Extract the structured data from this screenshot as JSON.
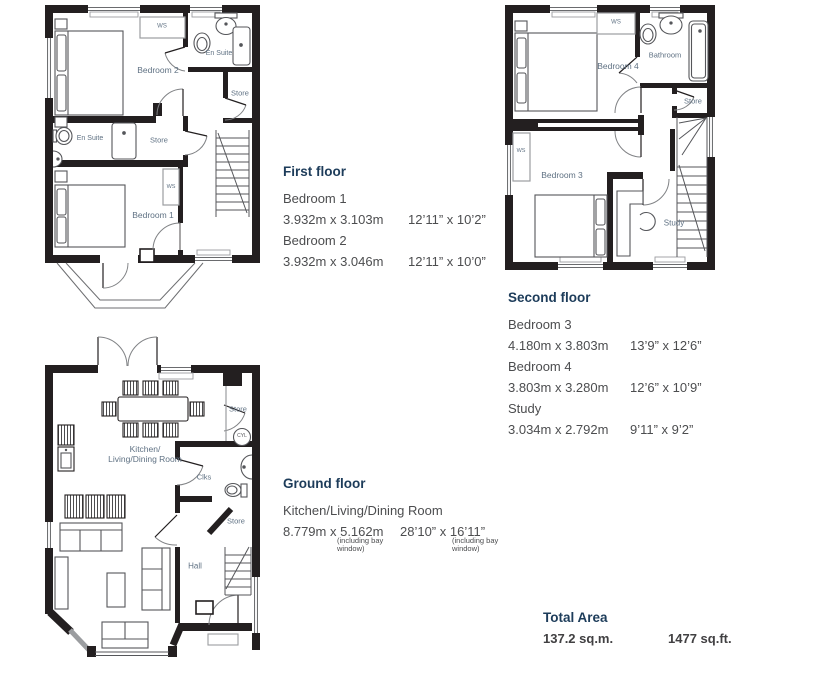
{
  "palette": {
    "wall": "#231f20",
    "heading": "#1d3c5a",
    "body_text": "#4c4d4f",
    "room_label": "#5f7183"
  },
  "sections": {
    "first_floor": {
      "title": "First floor",
      "rows": [
        {
          "room": "Bedroom 1",
          "metric": "3.932m x 3.103m",
          "imperial": "12’11” x 10’2”"
        },
        {
          "room": "Bedroom 2",
          "metric": "3.932m x 3.046m",
          "imperial": "12’11” x 10’0”"
        }
      ]
    },
    "second_floor": {
      "title": "Second floor",
      "rows": [
        {
          "room": "Bedroom 3",
          "metric": "4.180m x 3.803m",
          "imperial": "13’9” x 12’6”"
        },
        {
          "room": "Bedroom 4",
          "metric": "3.803m x 3.280m",
          "imperial": "12’6” x 10’9”"
        },
        {
          "room": "Study",
          "metric": "3.034m x 2.792m",
          "imperial": "9’11” x 9’2”"
        }
      ]
    },
    "ground_floor": {
      "title": "Ground floor",
      "rows": [
        {
          "room": "Kitchen/Living/Dining Room",
          "metric": "8.779m x 5.162m",
          "metric_note": "(including bay window)",
          "imperial": "28’10” x 16’11”",
          "imperial_note": "(including bay window)"
        }
      ]
    },
    "total": {
      "title": "Total Area",
      "metric": "137.2 sq.m.",
      "imperial": "1477 sq.ft."
    }
  },
  "plans": {
    "first_floor": {
      "labels": {
        "bedroom2": "Bedroom 2",
        "ws_top": "WS",
        "ensuite_top": "En Suite",
        "store_top": "Store",
        "ensuite_mid": "En Suite",
        "store_mid": "Store",
        "ws_mid": "WS",
        "bedroom1": "Bedroom 1"
      }
    },
    "second_floor": {
      "labels": {
        "bedroom4": "Bedroom 4",
        "ws_top": "WS",
        "bathroom": "Bathroom",
        "store": "Store",
        "ws_left": "WS",
        "bedroom3": "Bedroom 3",
        "study": "Study"
      }
    },
    "ground_floor": {
      "labels": {
        "kitchen_line1": "Kitchen/",
        "kitchen_line2": "Living/Dining Room",
        "store_top": "Store",
        "cyl": "CYL",
        "clks": "Clks",
        "hall": "Hall",
        "store_under_stairs": "Store"
      }
    }
  }
}
